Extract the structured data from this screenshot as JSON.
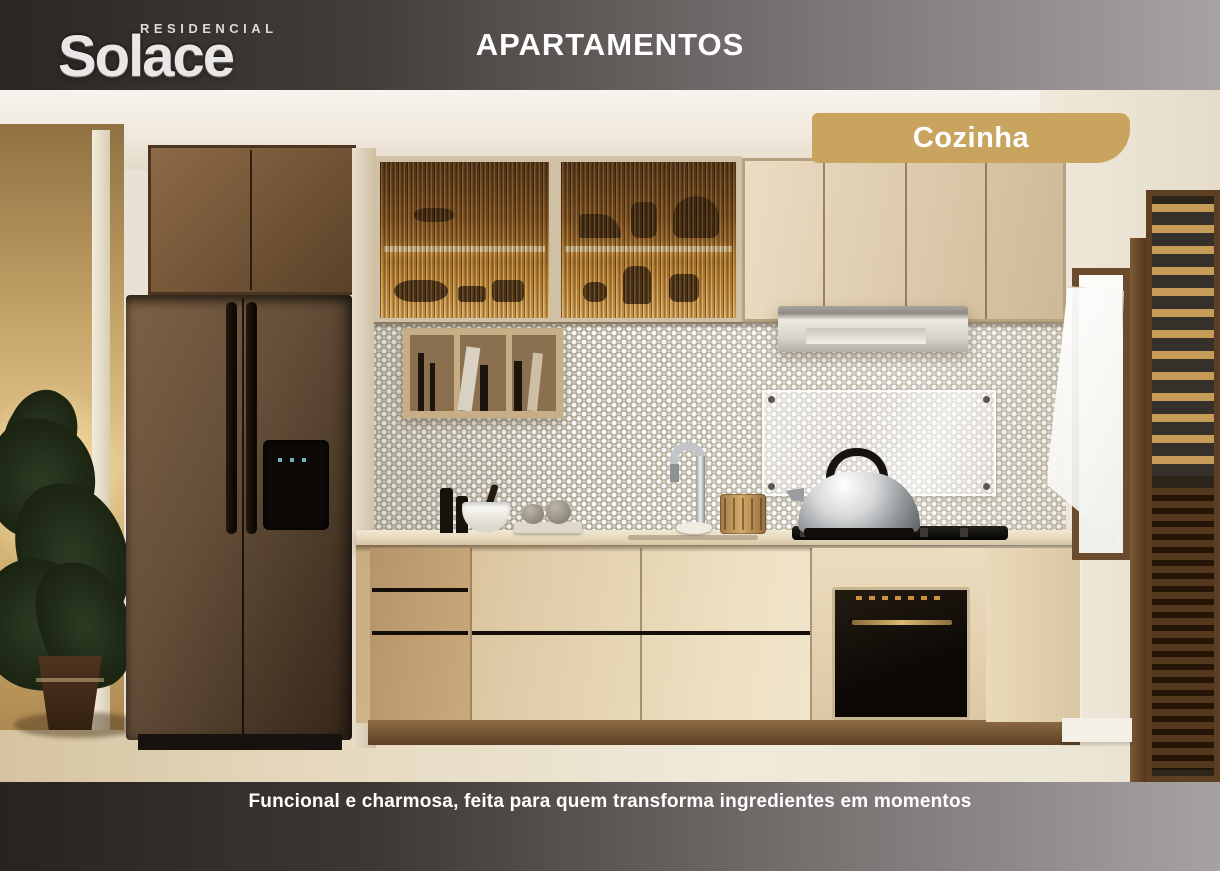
{
  "header": {
    "logo_brand": "Solace",
    "logo_tagline": "RESIDENCIAL",
    "title": "APARTAMENTOS"
  },
  "photo": {
    "badge_label": "Cozinha"
  },
  "footer": {
    "caption": "Funcional e charmosa, feita para quem transforma ingredientes em momentos"
  },
  "colors": {
    "badge_gold": "#C9A45F",
    "header_dark": "#2B2624",
    "header_light": "#A7A2A5",
    "footer_dark": "#282320",
    "footer_light": "#A6A2A3",
    "title_text": "#FFFFFF"
  }
}
